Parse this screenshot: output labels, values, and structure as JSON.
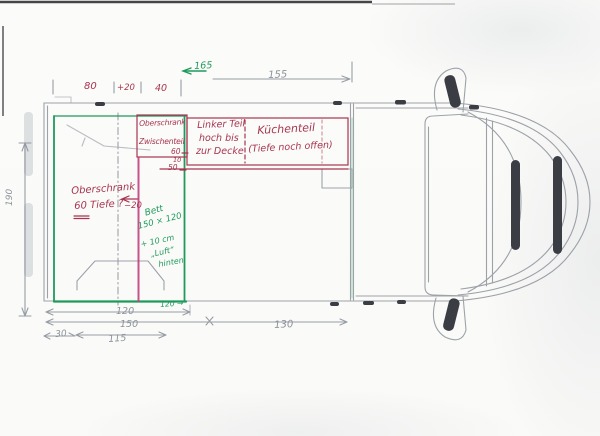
{
  "meta": {
    "title": "Hand-drawn camper van floor plan sketch (top view)"
  },
  "colors": {
    "red_ink": "#a83550",
    "green_ink": "#1f9a5c",
    "magenta_ink": "#c2407e",
    "pencil": "#8d939c",
    "dark_mark": "#3a3e44",
    "paper": "#fbfbf9"
  },
  "annotations": {
    "cabinet_top": {
      "line1": "Oberschrank",
      "line2": "Zwischenteil"
    },
    "left_part": {
      "line1": "Linker Teil",
      "line2": "hoch bis",
      "line3": "zur Decke"
    },
    "kitchen": {
      "line1": "Küchenteil",
      "line2": "(Tiefe noch offen)"
    },
    "cabinet_question": {
      "line1": "Oberschrank",
      "line2": "60 Tiefe ?"
    },
    "offset": {
      "value": "−20"
    },
    "depths": {
      "d60": "60",
      "d10": "10",
      "d50": "50"
    },
    "bed": {
      "line1": "Bett",
      "line2": "150 × 120",
      "line3": "+ 10 cm",
      "line4": "„Luft“",
      "line5": "hinten"
    },
    "green_width": "120 →"
  },
  "dimensions": {
    "top": {
      "d80": "80",
      "plus20": "+20",
      "d40": "40",
      "green165": "165",
      "d155": "155"
    },
    "left_height": "190",
    "bottom": {
      "d120": "120",
      "d150": "150",
      "d30": "30",
      "d115": "115",
      "d130": "130"
    }
  }
}
